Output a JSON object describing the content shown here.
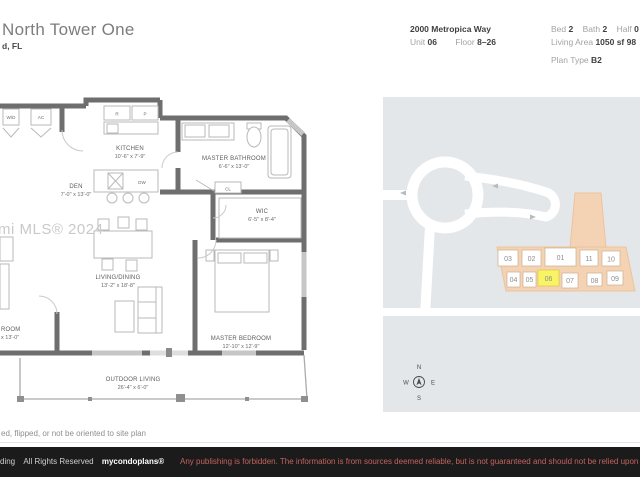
{
  "header": {
    "title": "North Tower One",
    "subtitle": "d, FL",
    "address": "2000 Metropica Way",
    "unit_label": "Unit",
    "unit_value": "06",
    "floor_label": "Floor",
    "floor_value": "8–26",
    "bed_label": "Bed",
    "bed_value": "2",
    "bath_label": "Bath",
    "bath_value": "2",
    "half_label": "Half",
    "half_value": "0",
    "living_area_label": "Living Area",
    "living_area_value": "1050 sf 98",
    "plan_type_label": "Plan Type",
    "plan_type_value": "B2"
  },
  "floorplan": {
    "watermark": "mi MLS® 2024",
    "rooms": [
      {
        "name": "DEN",
        "dims": "7'-0\" x 13'-0\""
      },
      {
        "name": "KITCHEN",
        "dims": "10'-6\" x 7'-9\""
      },
      {
        "name": "MASTER BATHROOM",
        "dims": "6'-6\" x 13'-0\""
      },
      {
        "name": "WIC",
        "dims": "6'-5\" x 8'-4\""
      },
      {
        "name": "LIVING/DINING",
        "dims": "13'-2\" x 18'-8\""
      },
      {
        "name": "MASTER BEDROOM",
        "dims": "12'-10\" x 12'-9\""
      },
      {
        "name": "ROOM",
        "dims": "x 13'-0\""
      },
      {
        "name": "OUTDOOR LIVING",
        "dims": "26'-4\" x 6'-0\""
      }
    ],
    "fixtures": {
      "wd": "W/D",
      "ac": "AC",
      "r": "R",
      "p": "P",
      "dw": "DW",
      "cl": "CL"
    }
  },
  "siteplan": {
    "units_top": [
      "03",
      "02",
      "01",
      "11",
      "10"
    ],
    "units_bottom": [
      "04",
      "05",
      "06",
      "07",
      "08",
      "09"
    ],
    "highlighted_unit": "06",
    "compass": {
      "n": "N",
      "e": "E",
      "s": "S",
      "w": "W"
    },
    "colors": {
      "background": "#e3e7e9",
      "road": "#ffffff",
      "building_fill": "#f3d3b4",
      "building_edge": "#ecc39c",
      "highlight_fill": "#f7f566",
      "highlight_edge": "#e8c24a"
    }
  },
  "disclaimer": "ed, flipped, or not be oriented to site plan",
  "footer": {
    "left_prefix": "ding",
    "rights": "All Rights Reserved",
    "brand": "mycondoplans®",
    "warning": "Any publishing is forbidden.  The information is from sources deemed reliable, but is not guaranteed and should not be relied upon without",
    "warning_color": "#c4635d"
  }
}
